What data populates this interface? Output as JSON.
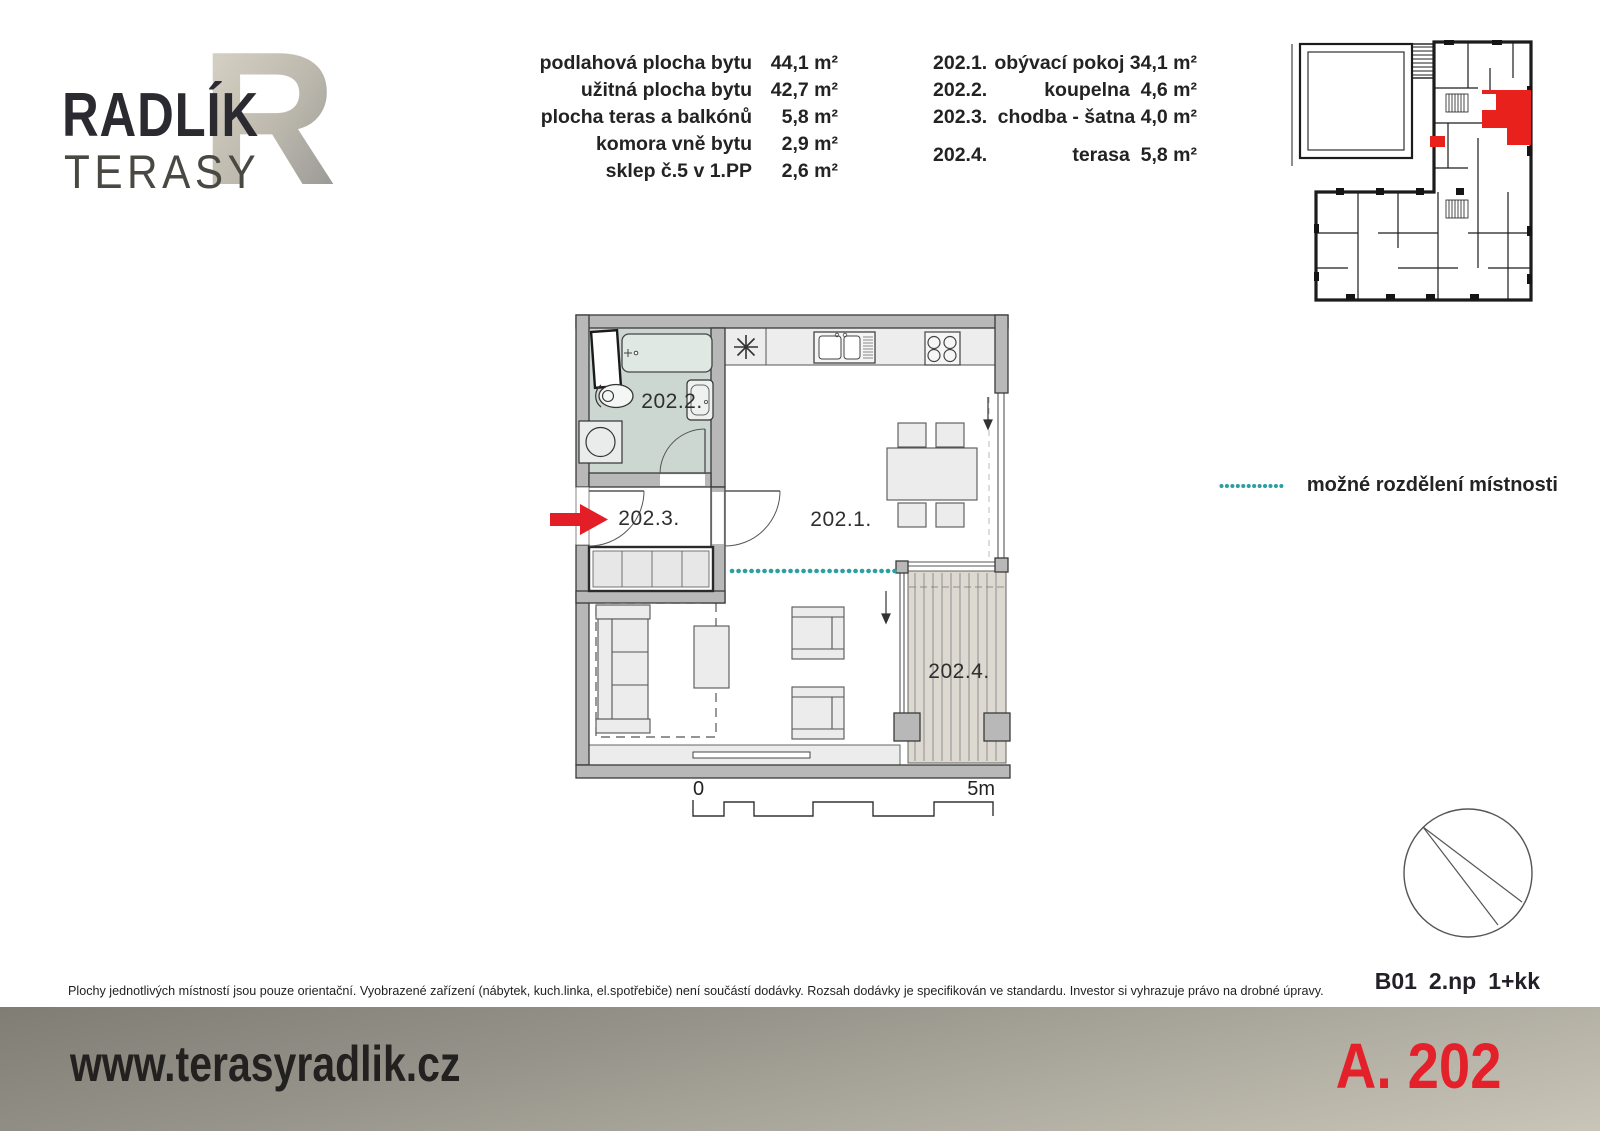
{
  "logo": {
    "monogram": "R",
    "title": "RADLÍK",
    "subtitle": "TERASY"
  },
  "area_table": {
    "rows": [
      {
        "label": "podlahová plocha bytu",
        "value": "44,1 m²"
      },
      {
        "label": "užitná plocha bytu",
        "value": "42,7 m²"
      },
      {
        "label": "plocha teras a balkónů",
        "value": "5,8 m²"
      },
      {
        "label": "komora vně bytu",
        "value": "2,9 m²"
      },
      {
        "label": "sklep č.5 v 1.PP",
        "value": "2,6 m²"
      }
    ]
  },
  "room_table": {
    "rows": [
      {
        "code": "202.1.",
        "name": "obývací pokoj",
        "area": "34,1 m²"
      },
      {
        "code": "202.2.",
        "name": "koupelna",
        "area": "4,6 m²"
      },
      {
        "code": "202.3.",
        "name": "chodba - šatna",
        "area": "4,0 m²"
      },
      {
        "code": "202.4.",
        "name": "terasa",
        "area": "5,8 m²"
      }
    ]
  },
  "plan": {
    "scale": {
      "start": "0",
      "end": "5m"
    },
    "colors": {
      "wall_fill": "#b8b8b8",
      "bathroom_floor": "#cdd7d2",
      "terrace_deck": "#ded9d0",
      "division_teal": "#2d9fa0",
      "entry_arrow_red": "#e31e26",
      "highlight_red": "#e8211c"
    }
  },
  "legend": {
    "label": "možné rozdělení místnosti"
  },
  "unit_meta": {
    "building": "B01",
    "floor": "2.np",
    "layout": "1+kk"
  },
  "disclaimer": "Plochy jednotlivých místností jsou pouze orientační. Vyobrazené zařízení (nábytek, kuch.linka, el.spotřebiče) není součástí dodávky.  Rozsah dodávky je specifikován ve standardu.  Investor si vyhrazuje právo na drobné úpravy.",
  "footer": {
    "website": "www.terasyradlik.cz",
    "unit_code": "A. 202"
  }
}
